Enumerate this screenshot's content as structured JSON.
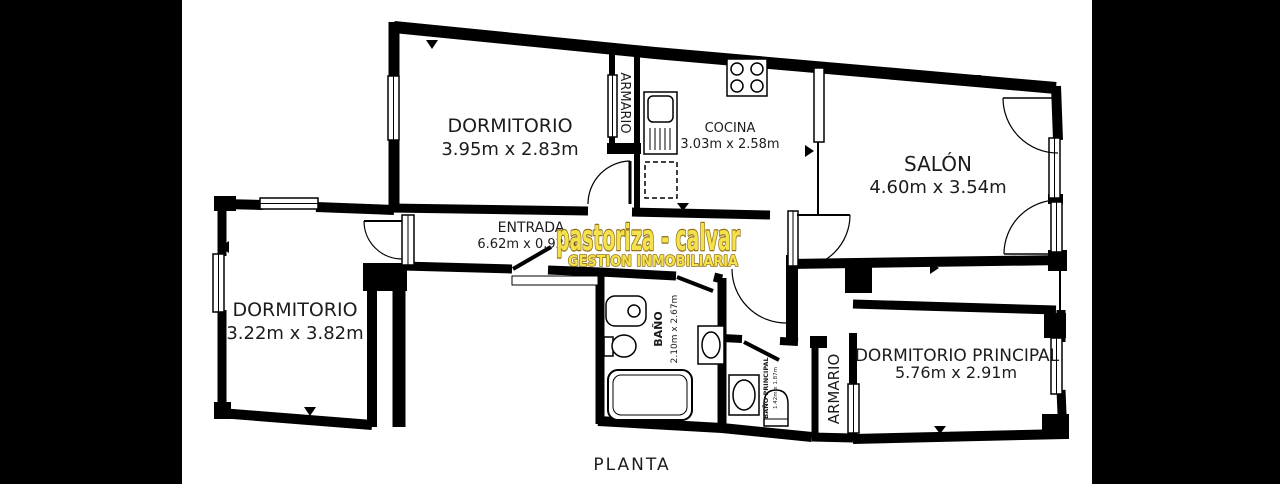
{
  "caption": "PLANTA",
  "watermark": {
    "line1": "pastoriza - calvar",
    "line2": "GESTION INMOBILIARIA"
  },
  "rooms": {
    "dormitorio1": {
      "name": "DORMITORIO",
      "dims": "3.95m x 2.83m"
    },
    "cocina": {
      "name": "COCINA",
      "dims": "3.03m x 2.58m"
    },
    "salon": {
      "name": "SALÓN",
      "dims": "4.60m x 3.54m"
    },
    "entrada": {
      "name": "ENTRADA",
      "dims": "6.62m x 0.92m"
    },
    "dormitorio2": {
      "name": "DORMITORIO",
      "dims": "3.22m x 3.82m"
    },
    "banio": {
      "name": "BAÑO",
      "dims": "2.10m x 2.67m"
    },
    "banio_principal": {
      "name": "BAÑO PRINCIPAL",
      "dims": "1.42m x 1.87m"
    },
    "armario_cocina": {
      "name": "ARMARIO"
    },
    "armario_principal": {
      "name": "ARMARIO"
    },
    "dormitorio_principal": {
      "name": "DORMITORIO PRINCIPAL",
      "dims": "5.76m x 2.91m"
    }
  },
  "colors": {
    "wall": "#000000",
    "background": "#ffffff",
    "label": "#1c1c1c",
    "watermark_fill": "#f3e24b",
    "watermark_outline": "#92701d"
  }
}
